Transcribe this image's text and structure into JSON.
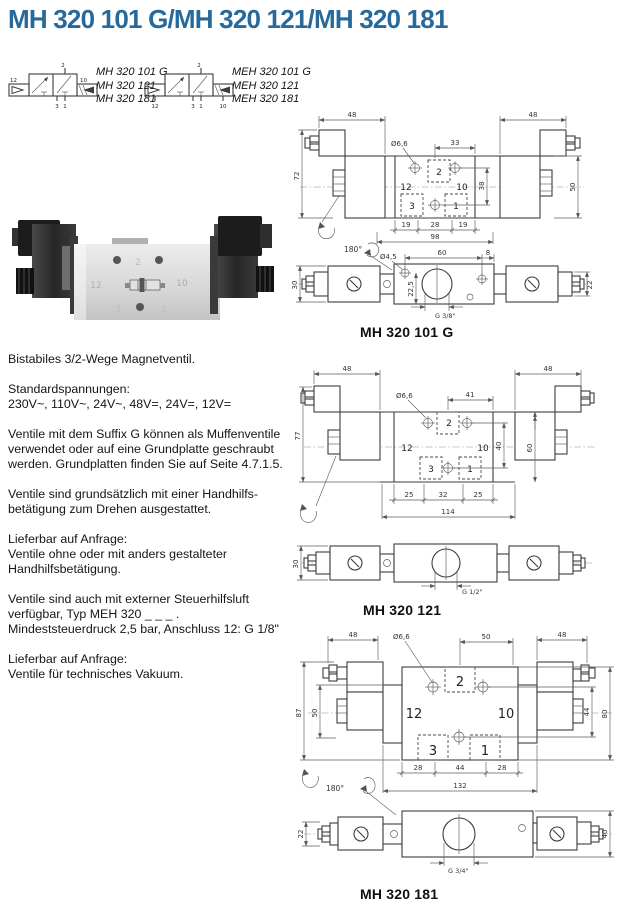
{
  "title": {
    "text": "MH 320 101 G/MH 320 121/MH 320 181",
    "color": "#26699a"
  },
  "symbols": {
    "left": {
      "variants": [
        "MH 320 101 G",
        "MH 320 121",
        "MH 320 181"
      ],
      "ports": {
        "t12": "12",
        "t2": "2",
        "t10": "10",
        "b3": "3",
        "b1": "1"
      }
    },
    "right": {
      "variants": [
        "MEH 320 101 G",
        "MEH 320 121",
        "MEH 320 181"
      ],
      "ports": {
        "b12": "12",
        "t2": "2",
        "b10": "10",
        "b3": "3",
        "b1": "1"
      }
    }
  },
  "photo": {
    "ports": {
      "p12": "12",
      "p2": "2",
      "p10": "10",
      "p3": "3",
      "p1": "1"
    }
  },
  "description": {
    "p1": "Bistabiles 3/2-Wege Magnetventil.",
    "p2": "Standardspannungen:\n230V~, 110V~, 24V~, 48V=, 24V=, 12V=",
    "p3": "Ventile mit dem Suffix G können als Muffenventile\nverwendet oder auf eine Grundplatte geschraubt\nwerden. Grundplatten finden Sie auf Seite 4.7.1.5.",
    "p4": "Ventile sind grundsätzlich mit einer Handhilfs-\nbetätigung zum Drehen ausgestattet.",
    "p5": "Lieferbar auf Anfrage:\nVentile ohne oder mit anders gestalteter\nHandhilfsbetätigung.",
    "p6": "Ventile sind auch mit externer Steuerhilfsluft\nverfügbar, Typ MEH 320 _ _ _ .\nMindeststeuerdruck 2,5 bar, Anschluss 12: G 1/8\"",
    "p7": "Lieferbar auf Anfrage:\nVentile für technisches Vakuum."
  },
  "drawing1": {
    "caption": "MH 320 101 G",
    "dim48l": "48",
    "dim48r": "48",
    "dim72": "72",
    "dim50": "50",
    "hole": "Ø6,6",
    "dim33": "33",
    "dim38": "38",
    "p2": "2",
    "p12": "12",
    "p10": "10",
    "p3": "3",
    "p1": "1",
    "dim19l": "19",
    "dim28": "28",
    "dim19r": "19",
    "dim98": "98",
    "rot": "180°",
    "hole2": "Ø4,5",
    "dim60": "60",
    "dim8": "8",
    "dim30": "30",
    "dim225": "22,5",
    "dim22": "22",
    "thread": "G 3/8\""
  },
  "drawing2": {
    "caption": "MH 320 121",
    "dim48l": "48",
    "dim48r": "48",
    "dim77": "77",
    "hole": "Ø6,6",
    "dim41": "41",
    "p2": "2",
    "p12": "12",
    "p10": "10",
    "p3": "3",
    "p1": "1",
    "dim40": "40",
    "dim60": "60",
    "dim25l": "25",
    "dim32": "32",
    "dim25r": "25",
    "dim114": "114",
    "dim30": "30",
    "thread": "G 1/2\""
  },
  "drawing3": {
    "caption": "MH 320 181",
    "dim48l": "48",
    "dim48r": "48",
    "hole": "Ø6,6",
    "dim50t": "50",
    "dim87": "87",
    "dim50l": "50",
    "dim44": "44",
    "dim80": "80",
    "p2": "2",
    "p12": "12",
    "p10": "10",
    "p3": "3",
    "p1": "1",
    "dim28l": "28",
    "dim44b": "44",
    "dim28r": "28",
    "dim132": "132",
    "rot": "180°",
    "dim22": "22",
    "dim40": "40",
    "thread": "G 3/4\""
  }
}
